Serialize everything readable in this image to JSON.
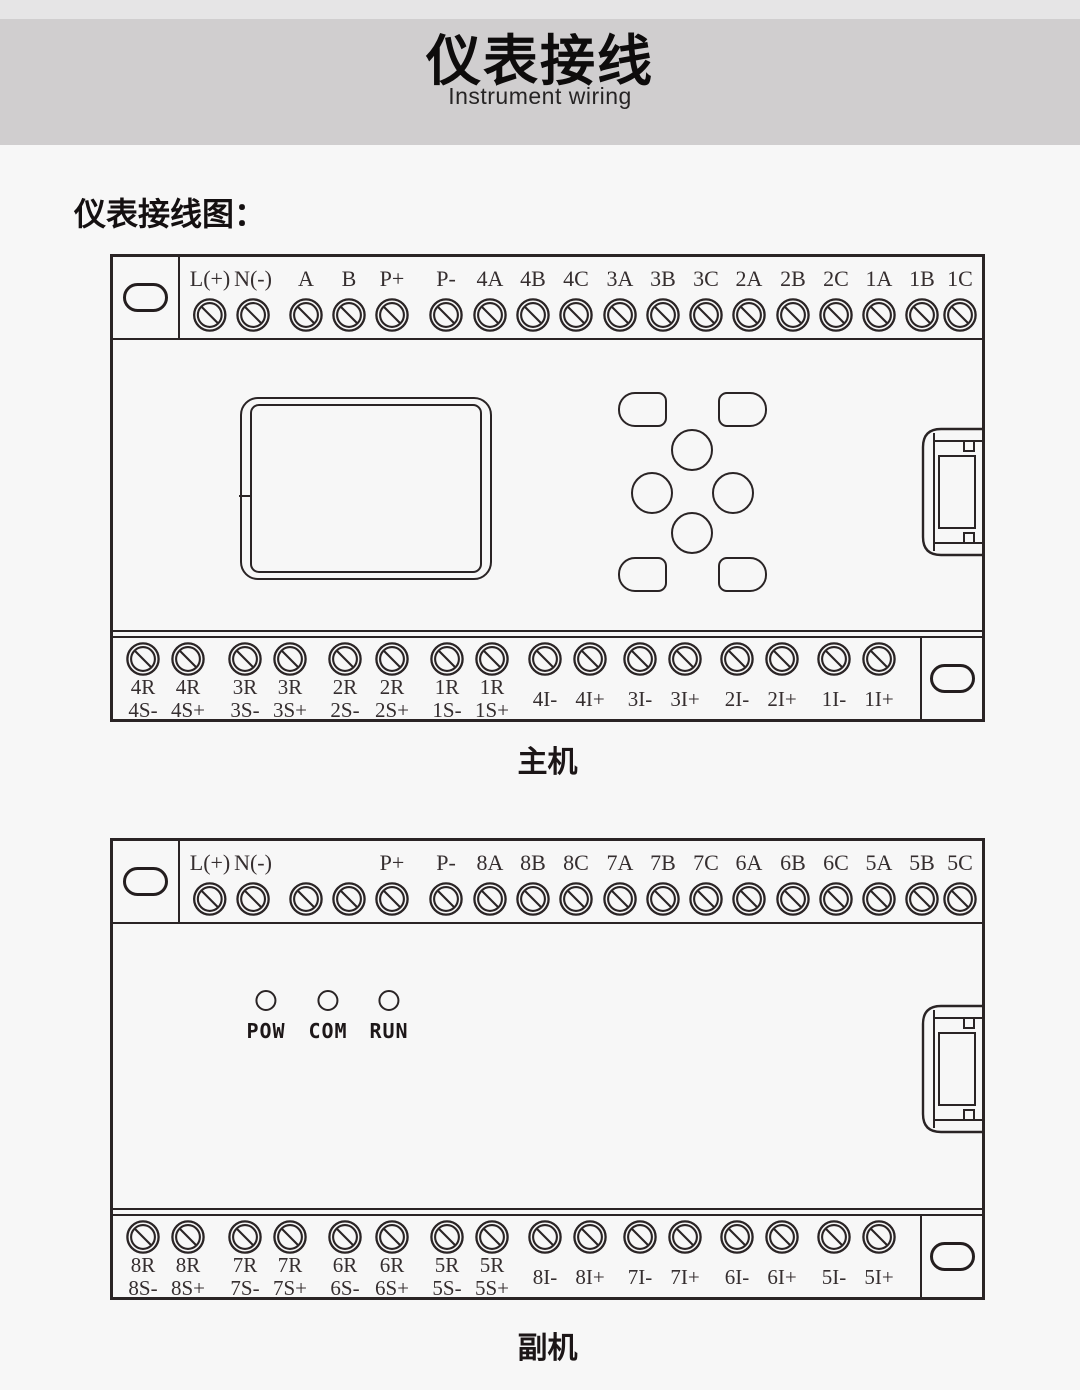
{
  "banner": {
    "title": "仪表接线",
    "subtitle": "Instrument wiring"
  },
  "heading": "仪表接线图：",
  "main_unit": {
    "caption": "主机",
    "top_terminals": [
      "L(+)",
      "N(-)",
      "A",
      "B",
      "P+",
      "P-",
      "4A",
      "4B",
      "4C",
      "3A",
      "3B",
      "3C",
      "2A",
      "2B",
      "2C",
      "1A",
      "1B",
      "1C"
    ],
    "bottom_dual": [
      [
        "4R",
        "4S-"
      ],
      [
        "4R",
        "4S+"
      ],
      [
        "3R",
        "3S-"
      ],
      [
        "3R",
        "3S+"
      ],
      [
        "2R",
        "2S-"
      ],
      [
        "2R",
        "2S+"
      ],
      [
        "1R",
        "1S-"
      ],
      [
        "1R",
        "1S+"
      ]
    ],
    "bottom_single": [
      "4I-",
      "4I+",
      "3I-",
      "3I+",
      "2I-",
      "2I+",
      "1I-",
      "1I+"
    ]
  },
  "sub_unit": {
    "caption": "副机",
    "top_terminals": [
      "L(+)",
      "N(-)",
      "",
      "",
      "P+",
      "P-",
      "8A",
      "8B",
      "8C",
      "7A",
      "7B",
      "7C",
      "6A",
      "6B",
      "6C",
      "5A",
      "5B",
      "5C"
    ],
    "leds": [
      "POW",
      "COM",
      "RUN"
    ],
    "bottom_dual": [
      [
        "8R",
        "8S-"
      ],
      [
        "8R",
        "8S+"
      ],
      [
        "7R",
        "7S-"
      ],
      [
        "7R",
        "7S+"
      ],
      [
        "6R",
        "6S-"
      ],
      [
        "6R",
        "6S+"
      ],
      [
        "5R",
        "5S-"
      ],
      [
        "5R",
        "5S+"
      ]
    ],
    "bottom_single": [
      "8I-",
      "8I+",
      "7I-",
      "7I+",
      "6I-",
      "6I+",
      "5I-",
      "5I+"
    ]
  },
  "colors": {
    "line": "#2a2425",
    "page_bg": "#f7f7f7",
    "banner_bg": "#d0cecf",
    "top_strip_bg": "#e6e5e6"
  }
}
